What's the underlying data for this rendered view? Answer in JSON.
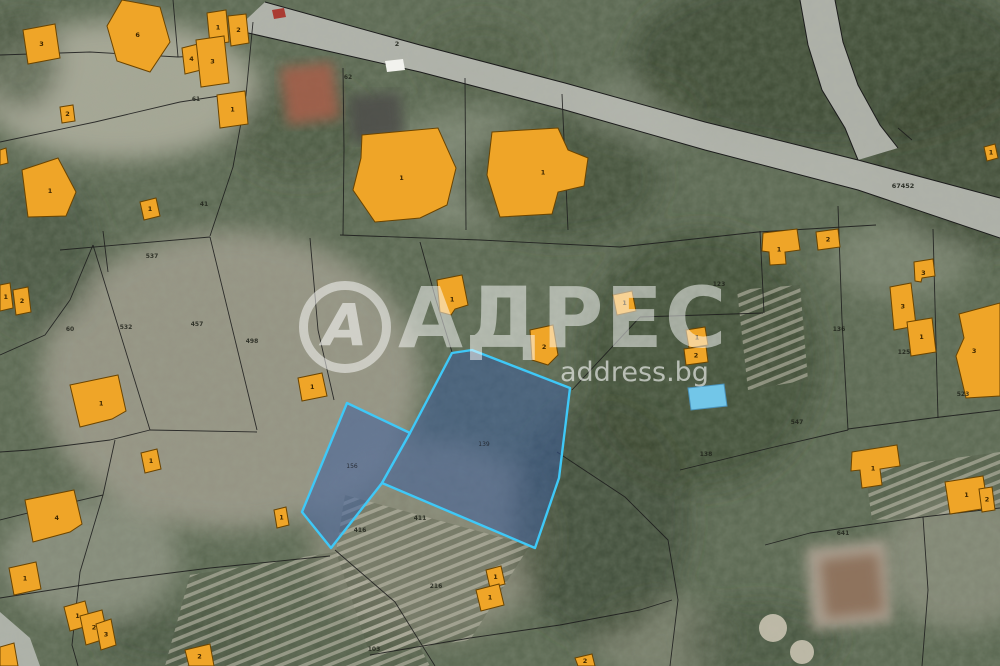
{
  "watermark": {
    "logo_letter": "А",
    "brand": "АДРЕС",
    "domain": "address.bg"
  },
  "colors": {
    "building_fill": "#EFA528",
    "building_stroke": "#6b4400",
    "building_label": "#3d2600",
    "boundary_line": "#1c1c1c",
    "parcel_number": "#1e2119",
    "highlight_fill": "rgba(58,92,158,0.52)",
    "highlight_stroke": "#3FC8F7",
    "road_fill": "#b6b9b1",
    "pool_fill": "#72C6E8",
    "pool_stroke": "#4a90b8"
  },
  "road_labels": [
    {
      "text": "2",
      "x": 397,
      "y": 46
    },
    {
      "text": "67452",
      "x": 903,
      "y": 188
    }
  ],
  "roads": {
    "main_top": "265,2 420,45 565,83 705,122 858,160 1000,198",
    "main_bottom": "235,30 420,72 565,110 705,150 858,190 1000,238",
    "branch_left": "800,0 808,45 822,90 845,128 858,160",
    "branch_right": "835,0 843,42 858,85 880,125 898,148",
    "extra": [
      "0,612 30,638 40,666 0,666"
    ]
  },
  "boundaries": [
    "173,0 178,57",
    "0,55 90,52 178,57 196,56",
    "0,142 95,122 180,102 245,92",
    "253,22 246,95 233,167 210,236",
    "343,68 344,150 343,235",
    "465,78 466,230",
    "340,235 480,240 620,247 758,232 876,225",
    "562,94 568,230",
    "93,245 150,430",
    "60,250 210,237",
    "760,231 764,313",
    "640,317 763,313",
    "838,206 842,320 848,430",
    "848,429 932,418 1000,410",
    "933,229 938,418",
    "103,231 108,272",
    "210,237 257,430",
    "150,430 257,432",
    "310,238 318,330 334,400",
    "420,242 436,300 452,352",
    "572,390 640,317",
    "557,452 625,497 668,540 678,600 670,666",
    "115,440 103,495 80,572 72,645 78,666",
    "0,452 30,450 110,440 150,430",
    "0,355 45,335 70,300 93,245",
    "0,520 60,505 103,495",
    "0,598 115,580 210,568 330,556",
    "335,550 395,602 435,666",
    "370,655 470,638 560,625 640,610 672,600",
    "680,470 770,448 848,430",
    "765,545 810,533 923,517 1000,508",
    "923,517 928,590 922,666",
    "898,128 912,140"
  ],
  "gardens": [
    "345,495 530,545 470,640 370,655 336,552",
    "865,470 1000,452 1000,505 925,517 872,520",
    "737,290 800,285 808,380 748,390",
    "190,575 335,552 400,610 430,666 165,666"
  ],
  "photo_features": {
    "houses": [
      {
        "points": "280,68 332,62 340,118 288,125",
        "fill": "#a4614b"
      },
      {
        "points": "348,96 400,92 404,138 352,142",
        "fill": "#50504c"
      },
      {
        "points": "806,548 885,540 892,622 812,630",
        "fill": "#b3a698"
      },
      {
        "points": "820,560 878,553 884,612 826,618",
        "fill": "#8b6e58"
      }
    ],
    "cars": [
      {
        "points": "385,61 403,59 405,70 387,72",
        "fill": "#f2f2ee"
      },
      {
        "points": "272,10 284,8 286,17 274,19",
        "fill": "#aa3b32"
      }
    ],
    "tanks": [
      {
        "cx": 773,
        "cy": 628,
        "r": 14
      },
      {
        "cx": 802,
        "cy": 652,
        "r": 12
      }
    ],
    "pool": {
      "points": "688,388 724,384 727,406 691,410"
    }
  },
  "buildings": [
    {
      "label": "3",
      "points": "23,30 55,24 60,58 28,64"
    },
    {
      "label": "6",
      "points": "122,0 160,7 170,42 150,72 117,61 107,26"
    },
    {
      "label": "1",
      "points": "207,13 226,10 229,42 210,45"
    },
    {
      "label": "2",
      "points": "228,16 246,14 249,43 231,46"
    },
    {
      "label": "4",
      "points": "182,48 198,44 201,70 185,74"
    },
    {
      "label": "3",
      "points": "196,40 224,36 229,83 201,87"
    },
    {
      "label": "2",
      "points": "60,107 73,105 75,121 62,123"
    },
    {
      "label": "1",
      "points": "217,95 245,91 248,124 220,128"
    },
    {
      "label": "1",
      "points": "22,170 58,158 76,192 66,216 28,217"
    },
    {
      "label": "1",
      "points": "140,202 156,198 160,216 144,220"
    },
    {
      "label": "1",
      "points": "362,135 438,128 456,168 447,205 420,218 375,222 353,190 361,158"
    },
    {
      "label": "1",
      "points": "492,132 558,128 568,150 588,158 584,186 558,192 552,214 500,217 487,175"
    },
    {
      "label": "1",
      "points": "437,280 462,275 468,305 455,309 451,315 440,312"
    },
    {
      "label": "2",
      "points": "530,330 553,325 558,355 548,365 532,360"
    },
    {
      "label": "1",
      "points": "613,295 632,291 636,311 617,315"
    },
    {
      "label": "1",
      "points": "686,330 705,327 708,345 689,348"
    },
    {
      "label": "2",
      "points": "684,349 706,346 708,362 686,365"
    },
    {
      "label": "1",
      "points": "763,233 797,229 800,250 785,252 786,264 770,265 769,252 762,251"
    },
    {
      "label": "2",
      "points": "816,232 838,229 840,247 818,250"
    },
    {
      "label": "3",
      "points": "914,262 933,259 935,276 922,278 921,282 915,281"
    },
    {
      "label": "3",
      "points": "890,287 911,283 916,326 894,330"
    },
    {
      "label": "1",
      "points": "907,322 932,318 936,352 911,356"
    },
    {
      "label": "3",
      "points": "959,314 1000,303 1000,396 966,398 956,356 964,338"
    },
    {
      "label": "1",
      "points": "70,385 118,375 126,411 112,419 80,427"
    },
    {
      "label": "1",
      "points": "298,378 322,373 327,396 302,401"
    },
    {
      "label": "1",
      "points": "0,285 10,283 13,308 0,311"
    },
    {
      "label": "2",
      "points": "13,290 28,287 31,312 16,315"
    },
    {
      "label": "4",
      "points": "25,500 74,490 82,524 70,532 33,542"
    },
    {
      "label": "1",
      "points": "9,568 36,562 41,589 14,595"
    },
    {
      "label": "1",
      "points": "141,453 157,449 161,469 145,473"
    },
    {
      "label": "1",
      "points": "274,510 286,507 289,525 277,528"
    },
    {
      "label": "1",
      "points": "64,607 85,601 91,625 70,631"
    },
    {
      "label": "2",
      "points": "80,616 102,610 108,638 86,645"
    },
    {
      "label": "3",
      "points": "96,624 111,619 116,645 101,650"
    },
    {
      "label": "2",
      "points": "185,650 210,644 214,666 189,666"
    },
    {
      "label": "1",
      "points": "486,570 501,566 505,584 490,588"
    },
    {
      "label": "1",
      "points": "476,590 499,584 504,605 481,611"
    },
    {
      "label": "1",
      "points": "852,452 897,445 900,466 880,469 882,485 862,488 860,470 851,471"
    },
    {
      "label": "1",
      "points": "945,482 983,476 988,508 950,514"
    },
    {
      "label": "2",
      "points": "979,489 992,487 995,510 982,512"
    },
    {
      "label": "1",
      "points": "984,147 995,144 998,158 987,161"
    },
    {
      "label": "",
      "points": "0,150 6,148 8,163 0,165"
    },
    {
      "label": "2",
      "points": "575,658 592,654 595,666 578,666"
    },
    {
      "label": "",
      "points": "0,647 14,643 18,666 0,666"
    }
  ],
  "highlight_parcels": [
    {
      "number": "156",
      "points": "347,403 410,433 382,483 331,548 302,512",
      "nx": 352,
      "ny": 468
    },
    {
      "number": "139",
      "points": "452,353 472,350 570,388 559,478 535,548 382,483 410,433",
      "nx": 484,
      "ny": 446
    }
  ],
  "parcel_numbers": [
    {
      "t": "61",
      "x": 196,
      "y": 101
    },
    {
      "t": "62",
      "x": 348,
      "y": 79
    },
    {
      "t": "537",
      "x": 152,
      "y": 258
    },
    {
      "t": "60",
      "x": 70,
      "y": 331
    },
    {
      "t": "532",
      "x": 126,
      "y": 329
    },
    {
      "t": "457",
      "x": 197,
      "y": 326
    },
    {
      "t": "498",
      "x": 252,
      "y": 343
    },
    {
      "t": "41",
      "x": 204,
      "y": 206
    },
    {
      "t": "123",
      "x": 719,
      "y": 286
    },
    {
      "t": "136",
      "x": 839,
      "y": 331
    },
    {
      "t": "125",
      "x": 904,
      "y": 354
    },
    {
      "t": "523",
      "x": 963,
      "y": 396
    },
    {
      "t": "547",
      "x": 797,
      "y": 424
    },
    {
      "t": "411",
      "x": 420,
      "y": 520
    },
    {
      "t": "416",
      "x": 360,
      "y": 532
    },
    {
      "t": "216",
      "x": 436,
      "y": 588
    },
    {
      "t": "103",
      "x": 374,
      "y": 651
    },
    {
      "t": "641",
      "x": 843,
      "y": 535
    },
    {
      "t": "138",
      "x": 706,
      "y": 456
    }
  ]
}
